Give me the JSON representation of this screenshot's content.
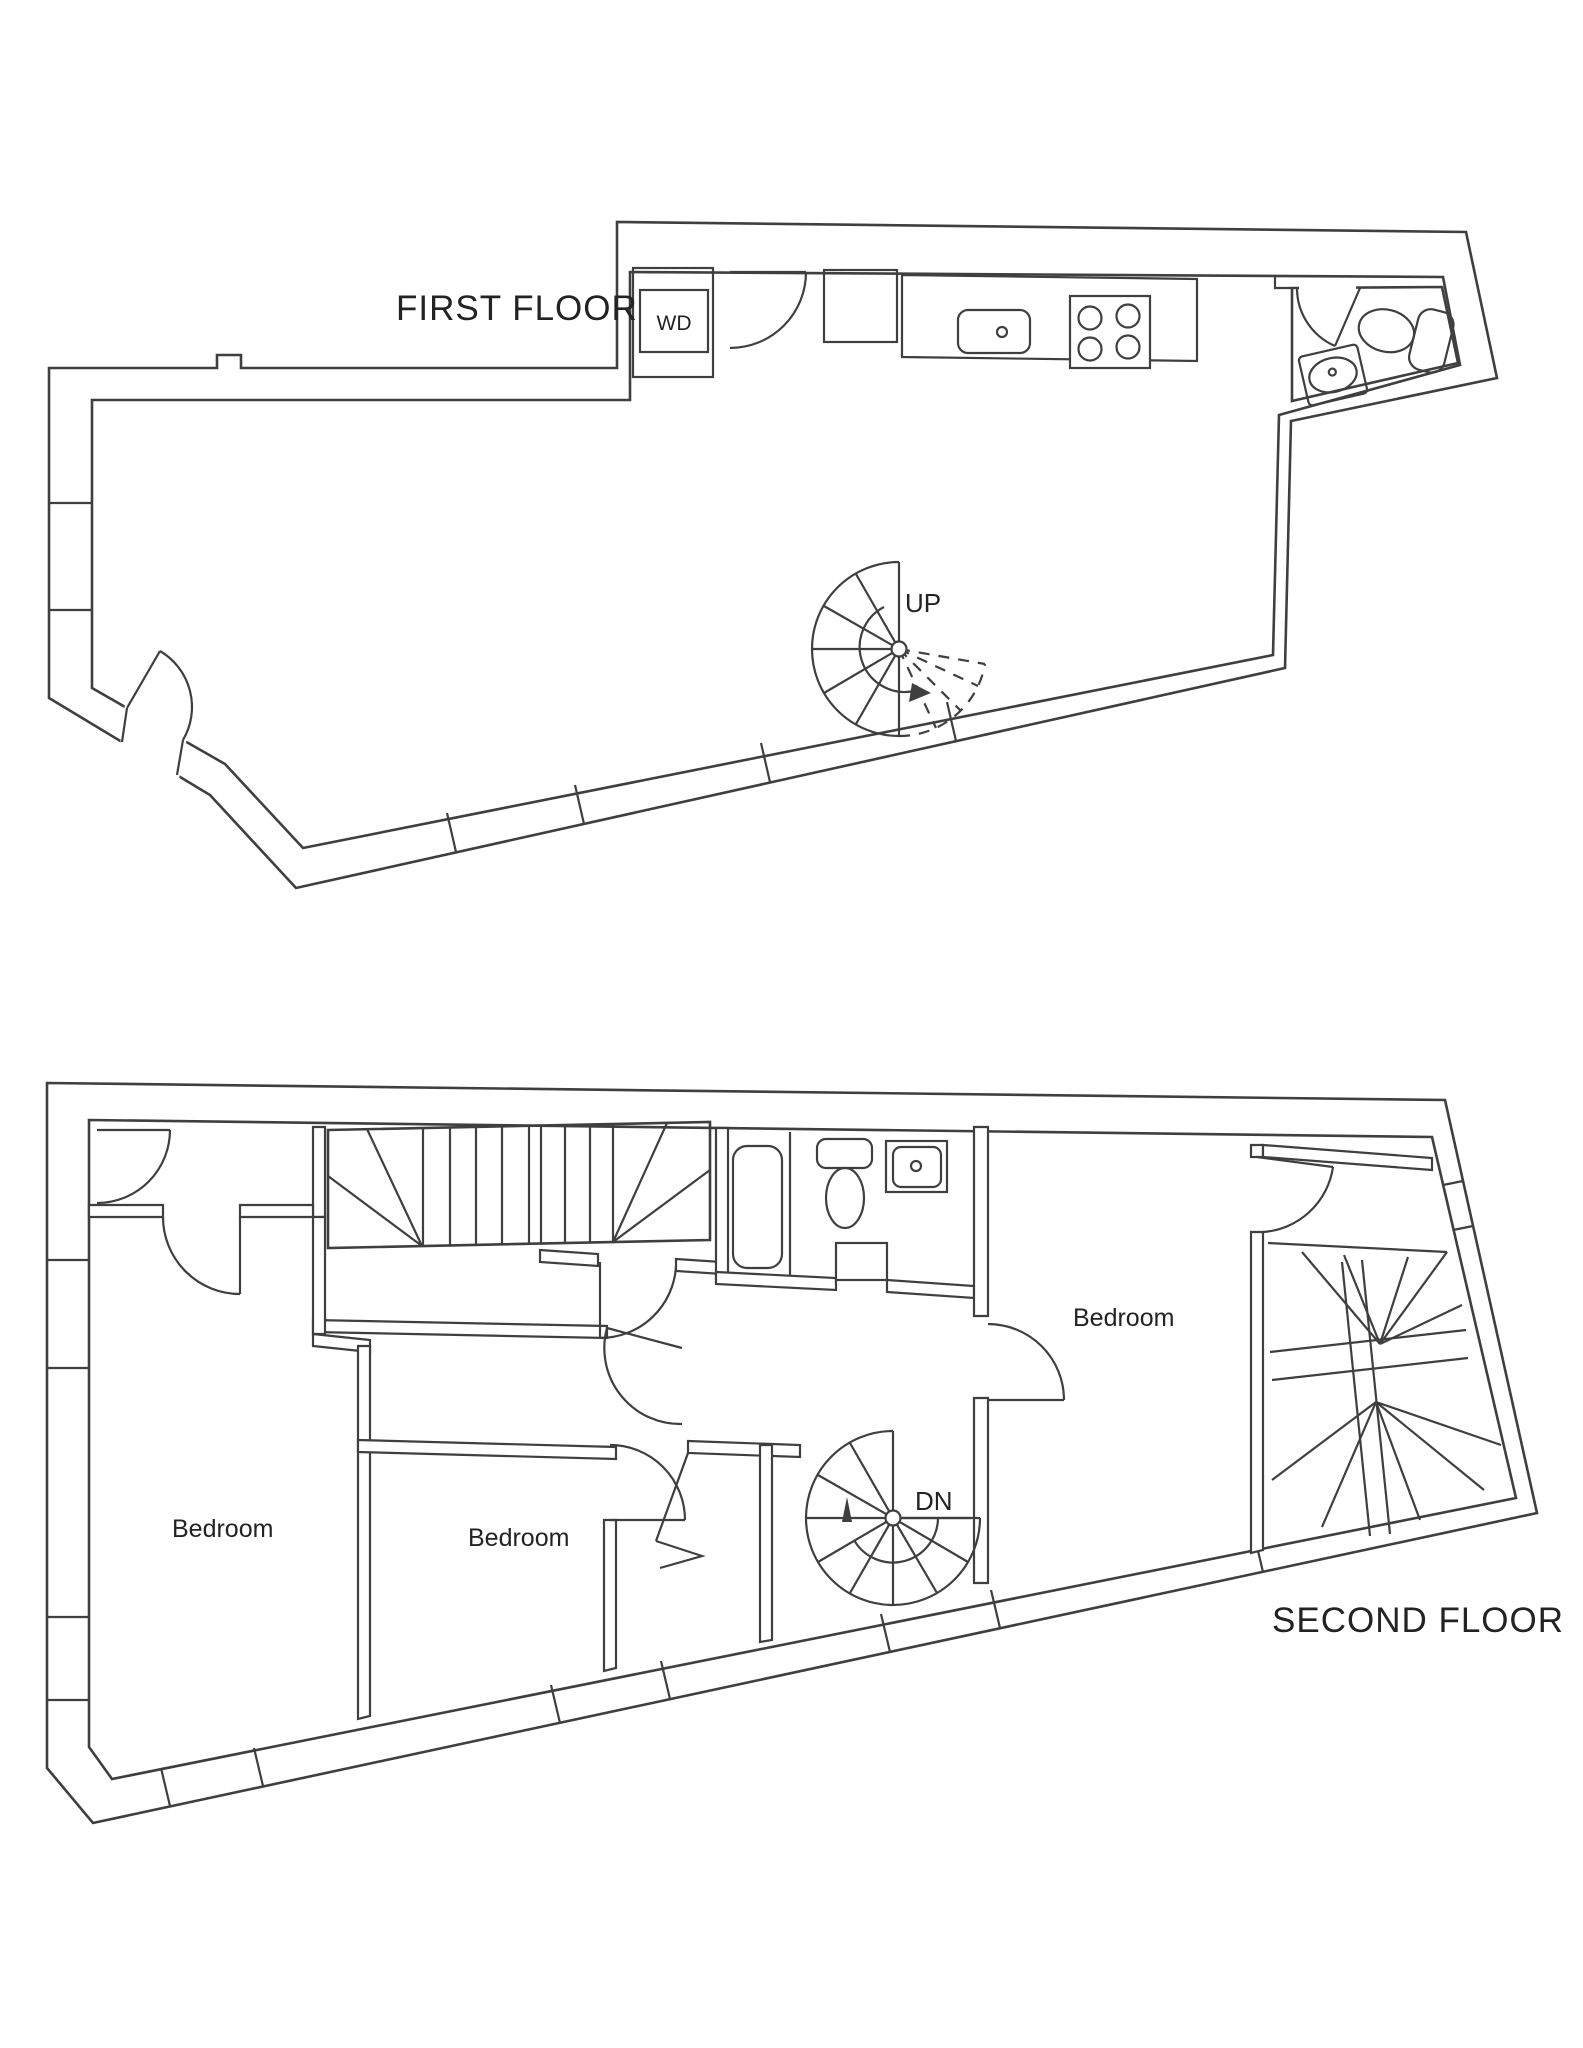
{
  "document": {
    "type": "floor-plan-drawing",
    "background_color": "#ffffff",
    "line_color": "#3f3f3f",
    "text_color": "#232323"
  },
  "first_floor": {
    "title": "FIRST FLOOR",
    "labels": {
      "washer_dryer": "WD",
      "stairs_up": "UP"
    },
    "features": [
      "kitchen counter with sink",
      "stove with 4 burners",
      "closet",
      "WD closet",
      "bathroom with sink and toilet",
      "spiral staircase up",
      "entry door",
      "windows"
    ]
  },
  "second_floor": {
    "title": "SECOND FLOOR",
    "labels": {
      "stairs_down": "DN",
      "bedroom_left": "Bedroom",
      "bedroom_center": "Bedroom",
      "bedroom_right": "Bedroom"
    },
    "features": [
      "straight staircase with winders",
      "bathroom with tub, toilet and sink",
      "spiral staircase down",
      "winder staircase",
      "three bedrooms",
      "windows"
    ]
  }
}
